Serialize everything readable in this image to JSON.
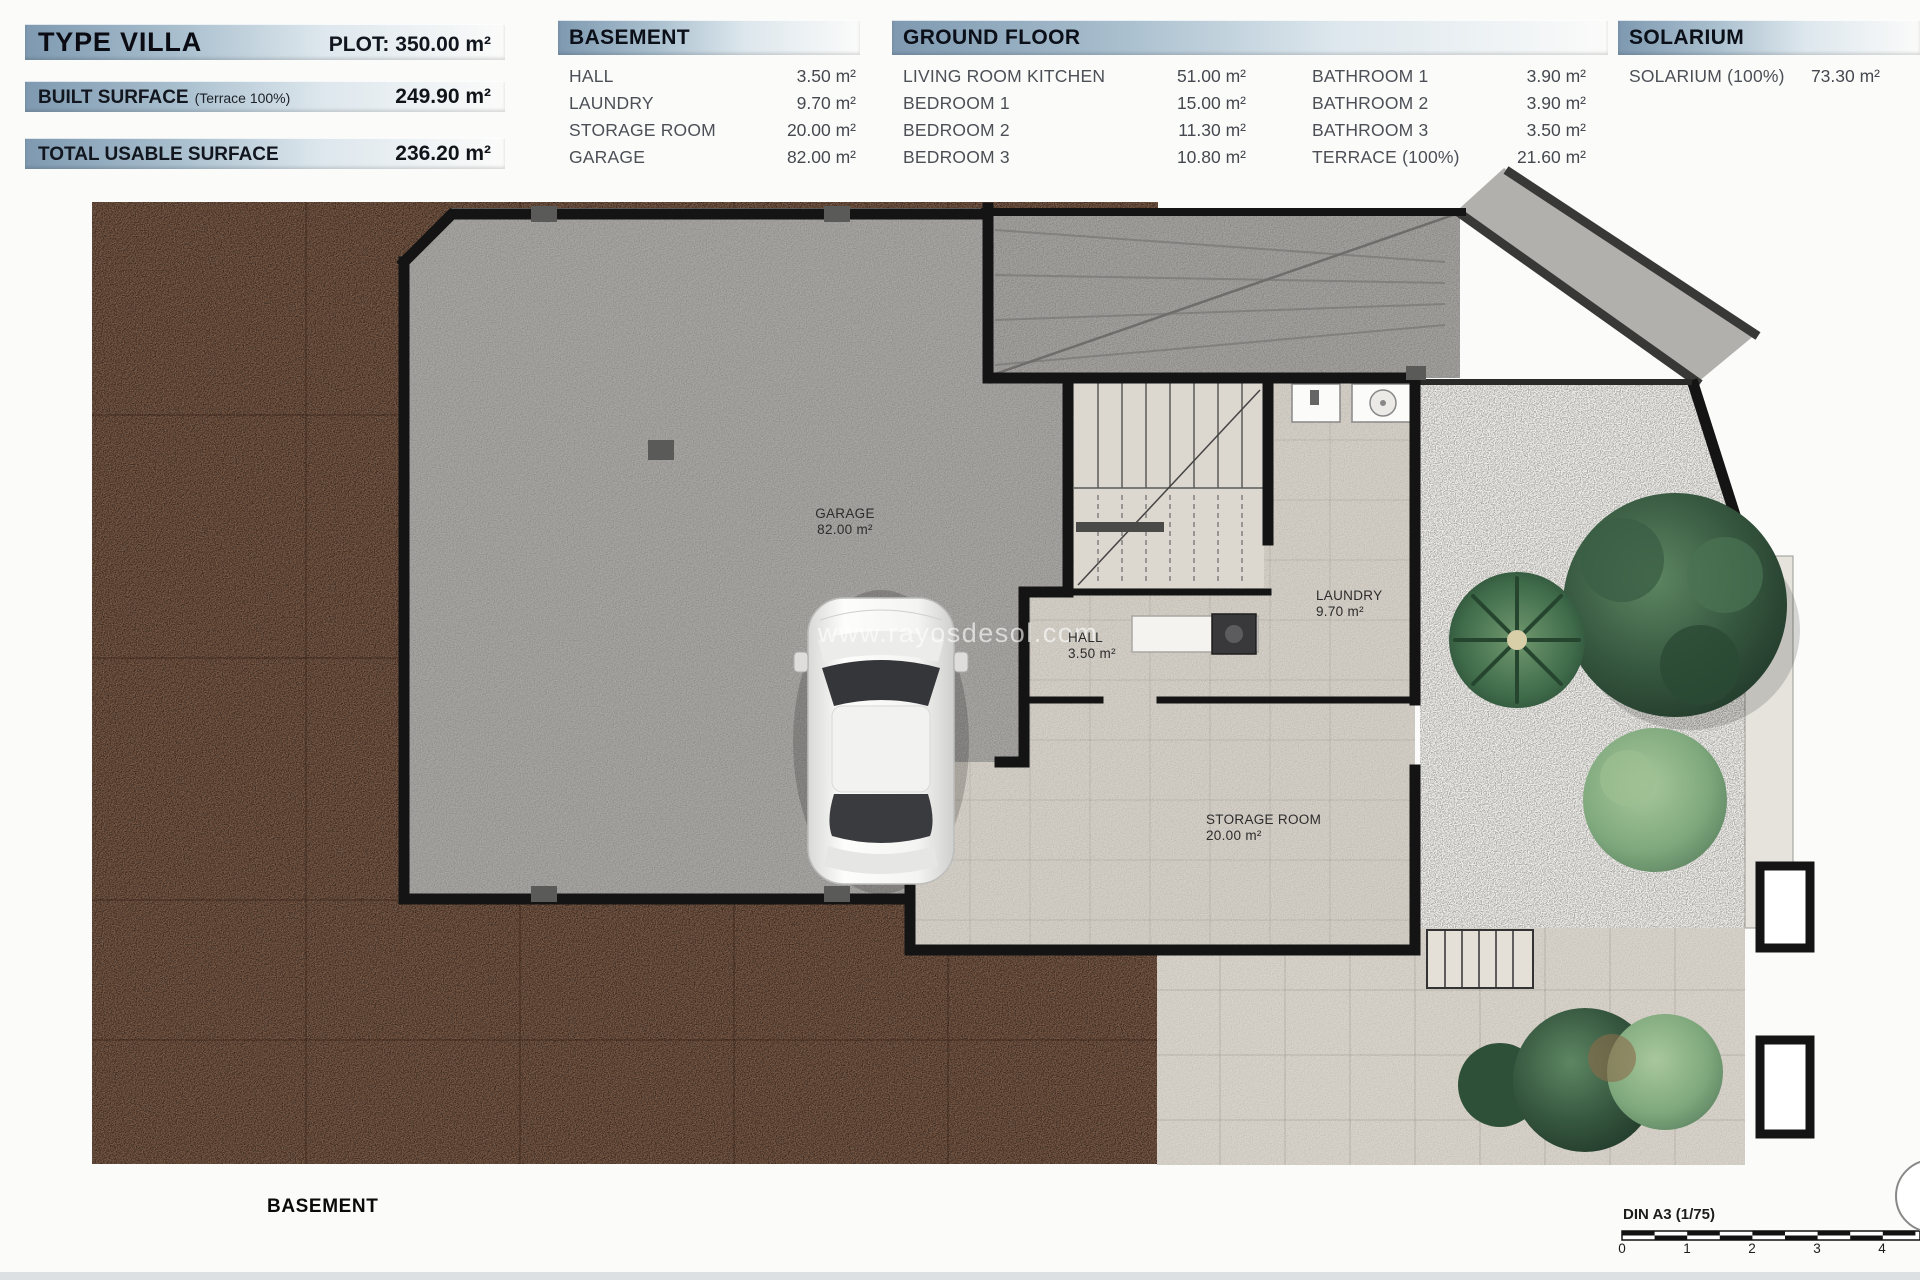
{
  "header": {
    "type_title": "TYPE VILLA",
    "plot": "PLOT: 350.00 m²",
    "built_surface_label": "BUILT SURFACE",
    "built_surface_note": "(Terrace 100%)",
    "built_surface_value": "249.90 m²",
    "total_usable_label": "TOTAL USABLE SURFACE",
    "total_usable_value": "236.20 m²"
  },
  "tables": {
    "basement": {
      "title": "BASEMENT",
      "rows": [
        {
          "label": "HALL",
          "value": "3.50 m²"
        },
        {
          "label": "LAUNDRY",
          "value": "9.70 m²"
        },
        {
          "label": "STORAGE ROOM",
          "value": "20.00 m²"
        },
        {
          "label": "GARAGE",
          "value": "82.00 m²"
        }
      ]
    },
    "ground_floor": {
      "title": "GROUND FLOOR",
      "col1": [
        {
          "label": "LIVING ROOM KITCHEN",
          "value": "51.00 m²"
        },
        {
          "label": "BEDROOM 1",
          "value": "15.00 m²"
        },
        {
          "label": "BEDROOM 2",
          "value": "11.30 m²"
        },
        {
          "label": "BEDROOM 3",
          "value": "10.80 m²"
        }
      ],
      "col2": [
        {
          "label": "BATHROOM 1",
          "value": "3.90 m²"
        },
        {
          "label": "BATHROOM 2",
          "value": "3.90 m²"
        },
        {
          "label": "BATHROOM 3",
          "value": "3.50 m²"
        },
        {
          "label": "TERRACE (100%)",
          "value": "21.60 m²"
        }
      ]
    },
    "solarium": {
      "title": "SOLARIUM",
      "rows": [
        {
          "label": "SOLARIUM (100%)",
          "value": "73.30 m²"
        }
      ]
    }
  },
  "plan": {
    "watermark": "www.rayosdesol.com",
    "caption": "BASEMENT",
    "labels": {
      "garage": {
        "name": "GARAGE",
        "area": "82.00 m²"
      },
      "hall": {
        "name": "HALL",
        "area": "3.50 m²"
      },
      "laundry": {
        "name": "LAUNDRY",
        "area": "9.70 m²"
      },
      "storage": {
        "name": "STORAGE ROOM",
        "area": "20.00 m²"
      }
    }
  },
  "scalebar": {
    "label": "DIN A3 (1/75)",
    "ticks": [
      "0",
      "1",
      "2",
      "3",
      "4"
    ]
  },
  "colors": {
    "bar_blue": "#7e99b0",
    "wall_black": "#141414",
    "dirt_brown": "#6f4e3a",
    "garage_concrete": "#a8a6a3",
    "interior_floor": "#d5d0c7",
    "garden_gravel": "#f1f0ec",
    "terrace_tile": "#d9d4cb",
    "tree_dark_green": "#2f4f3a",
    "tree_light_green": "#7fa97d"
  }
}
